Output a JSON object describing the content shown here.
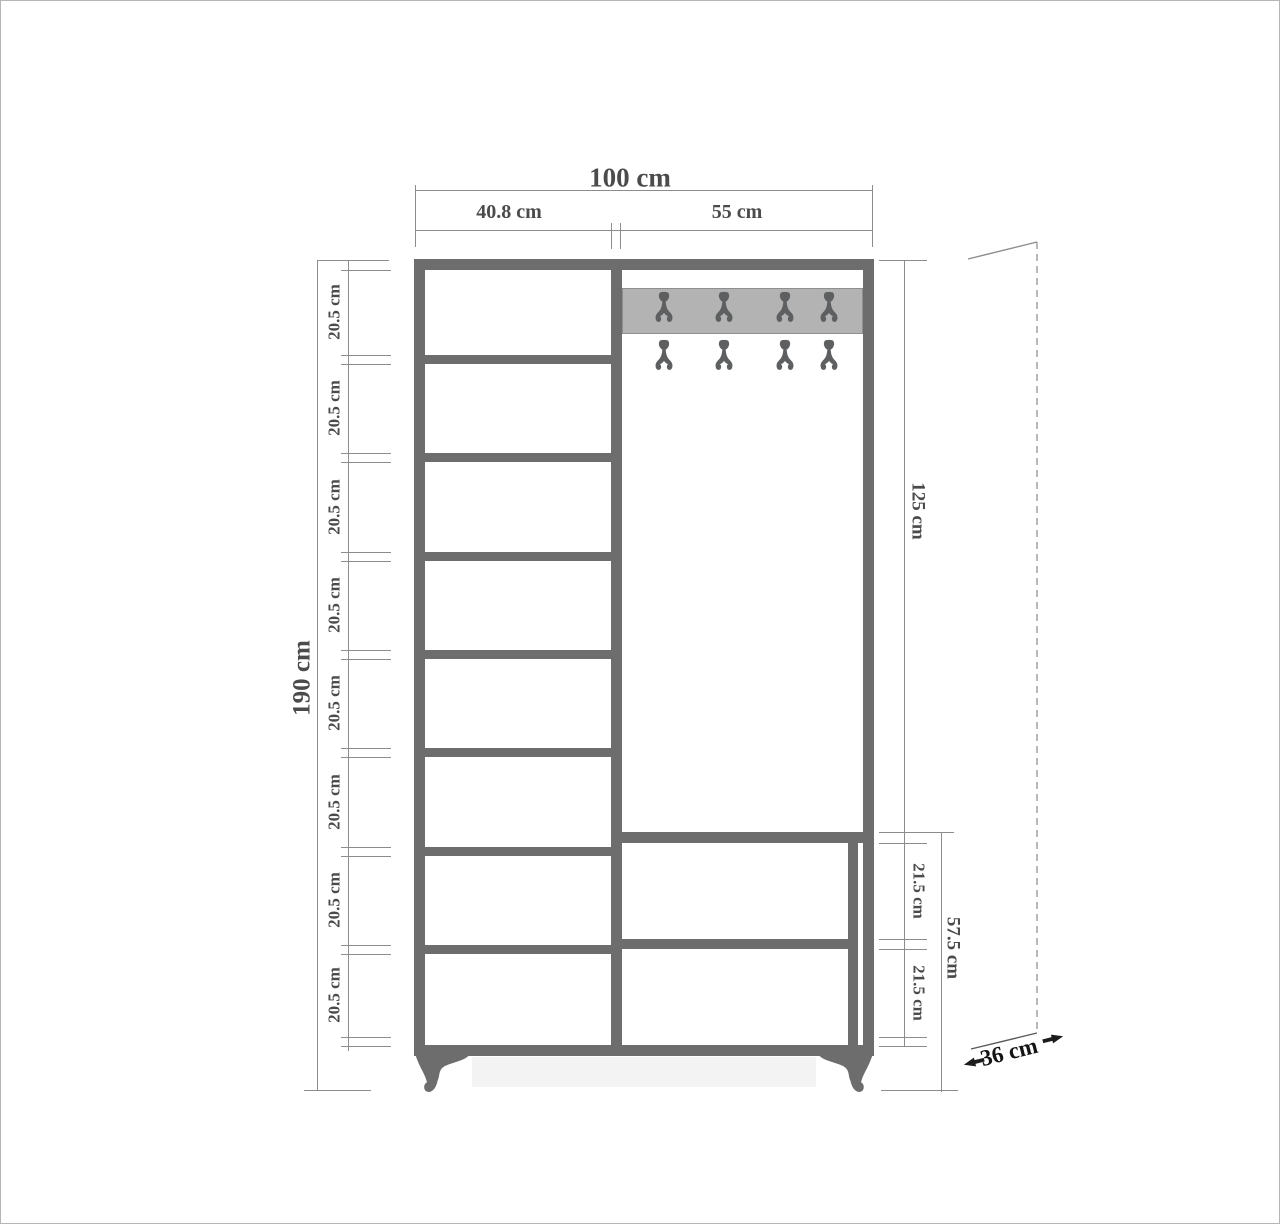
{
  "figure": {
    "type": "furniture-dimension-diagram",
    "subject": "hallway wardrobe with shelves, coat hooks and drawers",
    "unit": "cm"
  },
  "dims": {
    "total_width": "100 cm",
    "left_column_width": "40.8 cm",
    "right_column_width": "55 cm",
    "total_height": "190 cm",
    "shelf_heights": [
      "20.5 cm",
      "20.5 cm",
      "20.5 cm",
      "20.5 cm",
      "20.5 cm",
      "20.5 cm",
      "20.5 cm",
      "20.5 cm"
    ],
    "open_section_height": "125 cm",
    "drawer_heights": [
      "21.5 cm",
      "21.5 cm"
    ],
    "drawer_section_height": "57.5 cm",
    "depth": "36 cm"
  },
  "structure": {
    "shelf_compartments": 8,
    "hook_rows": 2,
    "hooks_per_row": 4,
    "drawers": 2,
    "feet": 2
  },
  "colors": {
    "frame": "#6d6d6d",
    "hook_rail": "#b3b3b3",
    "hook": "#5d5f61",
    "dimension_line": "#8c8c8c",
    "label_text": "#4b4b4b",
    "depth_annotation": "#141414",
    "background": "#ffffff",
    "page_border": "#b5b5b5"
  }
}
